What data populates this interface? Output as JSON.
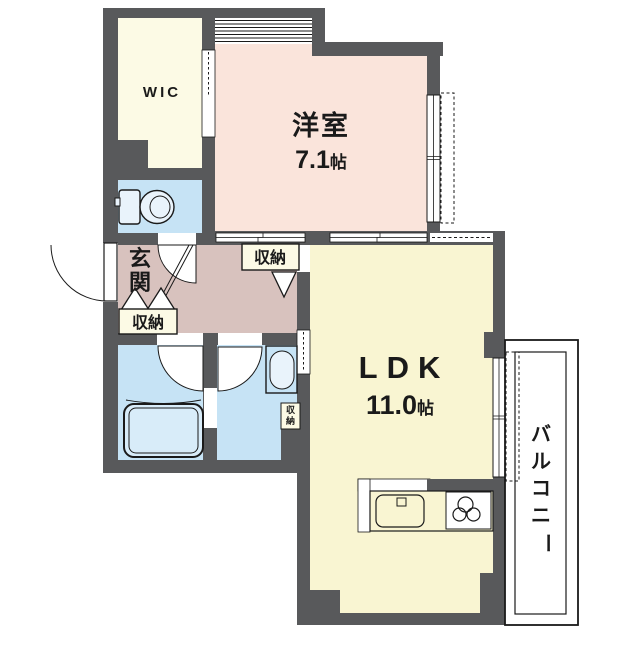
{
  "plan": {
    "title": "apartment-floor-plan",
    "rooms": {
      "wic": {
        "label": "WIC"
      },
      "western": {
        "label": "洋室",
        "size": "7.1",
        "unit": "帖"
      },
      "ldk": {
        "label": "LDK",
        "size": "11.0",
        "unit": "帖"
      },
      "genkan": {
        "chars": [
          "玄",
          "関"
        ]
      },
      "balcony": {
        "chars": [
          "バ",
          "ル",
          "コ",
          "ニ",
          "ー"
        ]
      },
      "closet_hall": {
        "label": "収納"
      },
      "closet_genkan": {
        "label": "収納"
      },
      "closet_wash": {
        "chars": [
          "収",
          "納"
        ]
      }
    },
    "colors": {
      "wall": "#58595B",
      "western": "#FAE4DB",
      "hall": "#D8C2BE",
      "wic": "#FCFAE5",
      "ldk": "#F9F5D2",
      "closet": "#FCFAE5",
      "water": "#C6E3F5",
      "fixture": "#E9F3FB",
      "tub": "#D8ECF9",
      "line": "#1A1A1A"
    }
  }
}
